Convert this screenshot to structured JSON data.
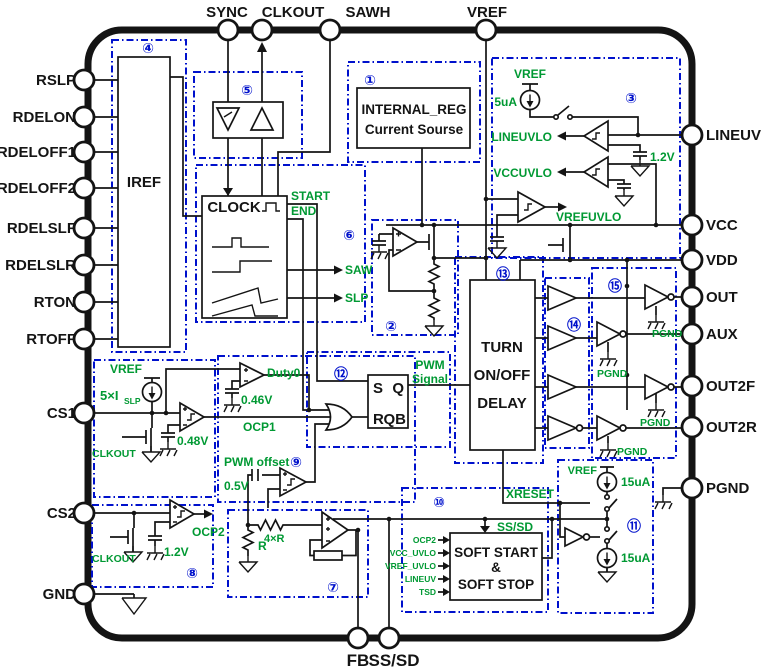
{
  "pins": {
    "top": [
      "SYNC",
      "CLKOUT",
      "SAWH",
      "VREF"
    ],
    "left": [
      "RSLP",
      "RDELON",
      "RDELOFF1",
      "RDELOFF2",
      "RDELSLF",
      "RDELSLR",
      "RTON",
      "RTOFF",
      "CS1",
      "CS2",
      "GND"
    ],
    "right": [
      "LINEUV",
      "VCC",
      "VDD",
      "OUT",
      "AUX",
      "OUT2F",
      "OUT2R",
      "PGND"
    ],
    "bottom": [
      "FB",
      "SS/SD"
    ]
  },
  "blocks": {
    "b1": {
      "num": "①",
      "line1": "INTERNAL_REG",
      "line2": "Current Sourse"
    },
    "b2": {
      "num": "②"
    },
    "b3": {
      "num": "③",
      "vref": "VREF",
      "cur": "5uA",
      "lineuvlo": "LINEUVLO",
      "vccuvlo": "VCCUVLO",
      "vrefuvlo": "VREFUVLO",
      "ref": "1.2V"
    },
    "b4": {
      "num": "④",
      "label": "IREF"
    },
    "b5": {
      "num": "⑤"
    },
    "b6": {
      "num": "⑥",
      "clock": "CLOCK",
      "start": "START",
      "end": "END",
      "saw": "SAW",
      "slp": "SLP"
    },
    "b7": {
      "num": "⑦",
      "r": "R",
      "r4": "4×R"
    },
    "b8": {
      "num": "⑧",
      "clkout": "CLKOUT",
      "ref": "1.2V",
      "ocp2": "OCP2"
    },
    "b9": {
      "num": "⑨",
      "duty0": "Duty0",
      "duty_ref": "0.46V",
      "offset_label": "PWM offset",
      "offset_ref": "0.5V"
    },
    "b10": {
      "num": "⑩",
      "xreset": "XRESET",
      "ssd": "SS/SD",
      "inputs": [
        "OCP2",
        "VCC_UVLO",
        "VREF_UVLO",
        "LINEUV",
        "TSD"
      ],
      "t1": "SOFT START",
      "t2": "&",
      "t3": "SOFT STOP"
    },
    "b11": {
      "num": "⑪",
      "vref": "VREF",
      "i_top": "15uA",
      "i_bot": "15uA"
    },
    "b12": {
      "num": "⑫",
      "s": "S",
      "q": "Q",
      "r": "R",
      "qb": "QB",
      "sig1": "PWM",
      "sig2": "Signal"
    },
    "b13": {
      "num": "⑬",
      "l1": "TURN",
      "l2": "ON/OFF",
      "l3": "DELAY"
    },
    "b14": {
      "num": "⑭"
    },
    "b15": {
      "num": "⑮",
      "pgnd": "PGND"
    }
  },
  "cs1": {
    "vref": "VREF",
    "islp": "5×I",
    "islp_sub": "SLP",
    "clkout": "CLKOUT",
    "ref": "0.48V",
    "ocp1": "OCP1"
  },
  "colors": {
    "green": "#009933",
    "blue": "#0011cc",
    "black": "#141414"
  }
}
